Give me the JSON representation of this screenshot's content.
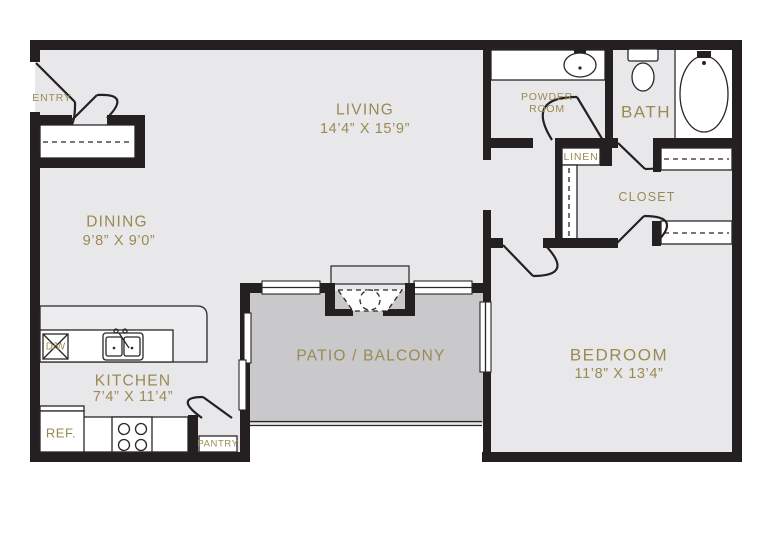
{
  "plan": {
    "type": "apartment-floor-plan",
    "colors": {
      "wall": "#241f21",
      "floor": "#e8e8ea",
      "patio_floor": "#c9c9cb",
      "label_text": "#9a8a52",
      "fixture_fill": "#ffffff"
    },
    "rooms": {
      "entry": {
        "label": "ENTRY"
      },
      "living": {
        "label": "LIVING",
        "dimensions": "14’4” X 15’9”"
      },
      "powder": {
        "label_line1": "POWDER",
        "label_line2": "ROOM"
      },
      "bath": {
        "label": "BATH"
      },
      "linen": {
        "label": "LINEN"
      },
      "closet": {
        "label": "CLOSET"
      },
      "dining": {
        "label": "DINING",
        "dimensions": "9’8” X 9’0”"
      },
      "kitchen": {
        "label": "KITCHEN",
        "dimensions": "7’4” X 11’4”"
      },
      "pantry": {
        "label": "PANTRY"
      },
      "patio": {
        "label": "PATIO / BALCONY"
      },
      "bedroom": {
        "label": "BEDROOM",
        "dimensions": "11’8” X 13’4”"
      }
    },
    "fixtures": {
      "refrigerator": {
        "label": "REF."
      },
      "dishwasher": {
        "label": "D/W"
      }
    }
  }
}
